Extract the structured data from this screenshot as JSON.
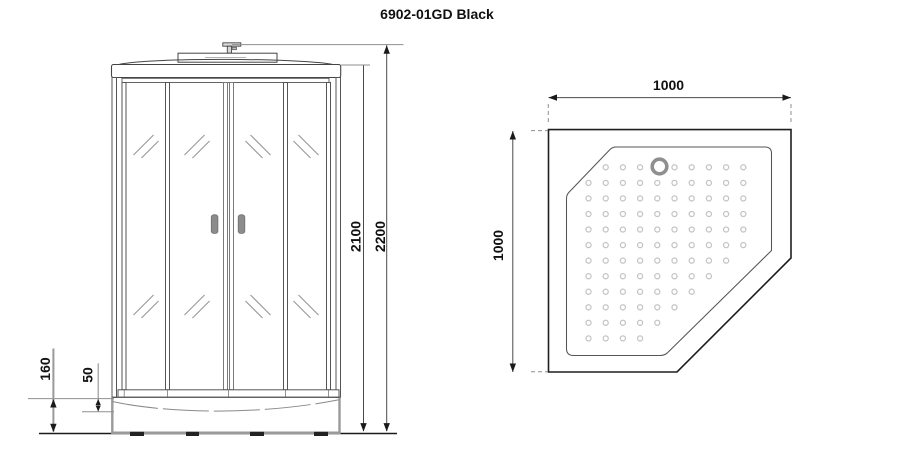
{
  "title": "6902-01GD Black",
  "front_view": {
    "dims": {
      "total_height": "2200",
      "cabin_height": "2100",
      "tray_height": "160",
      "tray_step": "50"
    }
  },
  "top_view": {
    "dims": {
      "width": "1000",
      "depth": "1000"
    }
  },
  "colors": {
    "handle_gray": "#8c8c8c",
    "drain_gray": "#8f8f8f",
    "dot_gray": "#c4c4c4"
  }
}
